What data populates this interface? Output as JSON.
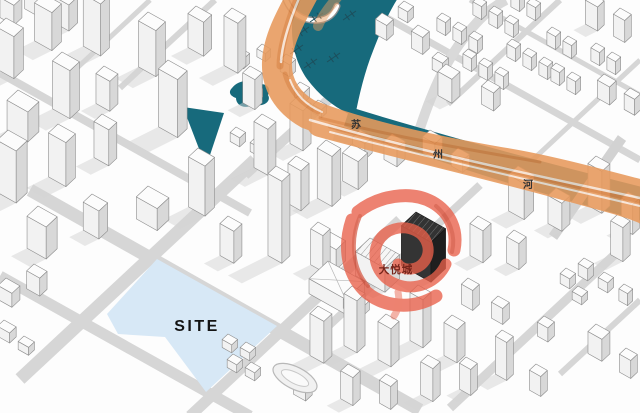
{
  "map": {
    "title": "axonometric urban site analysis map",
    "labels": {
      "site": "SITE",
      "landmark": "大悦城",
      "river_chars": [
        "苏",
        "州",
        "河"
      ]
    },
    "colors": {
      "water": "#176a7c",
      "flow": "#e89a5c",
      "flow_dark": "#d87c38",
      "highlight": "#e9604a",
      "highlight_deep": "#d04028",
      "site_fill": "#d7e8f6",
      "site_label": "#141414",
      "river_label": "#333333",
      "landmark_label": "#76241a"
    }
  }
}
